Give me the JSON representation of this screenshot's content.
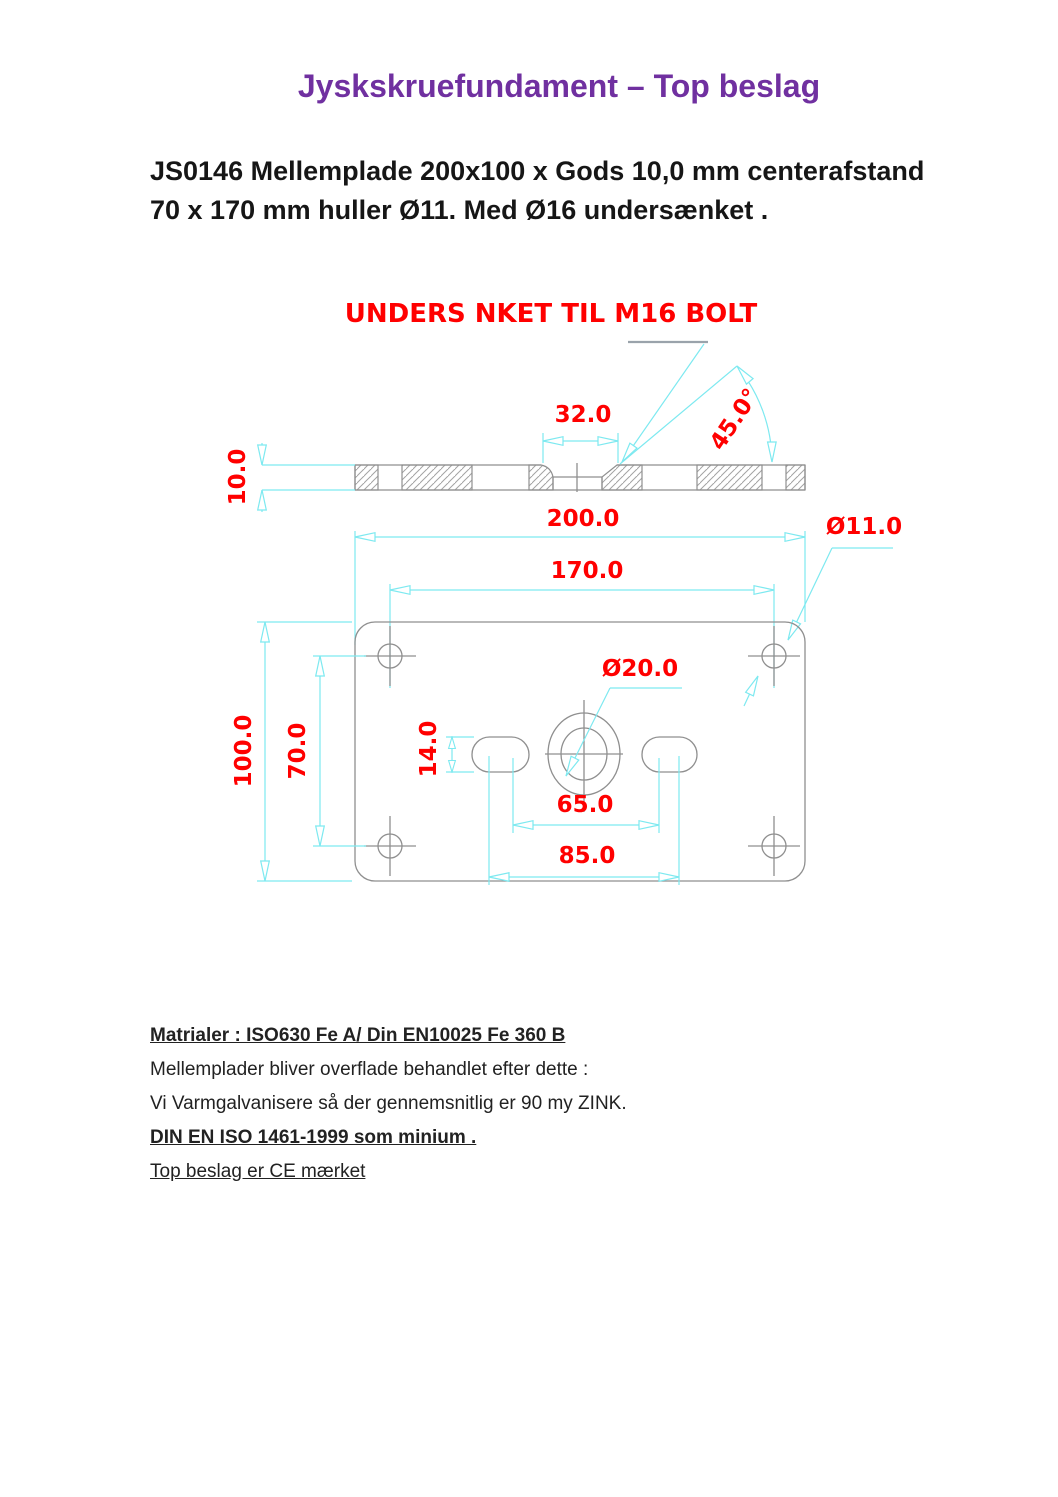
{
  "page": {
    "title": "Jyskskruefundament – Top beslag",
    "heading_line1": "JS0146 Mellemplade 200x100 x Gods 10,0 mm centerafstand",
    "heading_line2": "70 x 170 mm huller Ø11. Med Ø16 undersænket ."
  },
  "drawing": {
    "note": "UNDERS NKET TIL M16 BOLT",
    "labels": {
      "thickness": "10.0",
      "countersink_width": "32.0",
      "countersink_angle": "45.0°",
      "plate_length": "200.0",
      "hole_diameter": "Ø11.0",
      "hole_spacing_length": "170.0",
      "center_hole_diameter": "Ø20.0",
      "plate_width": "100.0",
      "hole_spacing_width": "70.0",
      "slot_width": "14.0",
      "slot_inner_spacing": "65.0",
      "slot_outer_spacing": "85.0"
    },
    "colors": {
      "dimension_text": "#ff0000",
      "dimension_lines": "#7de9f0",
      "geometry_lines": "#8f8f8f",
      "note_text": "#ff0000"
    }
  },
  "footer": {
    "materials": "Matrialer : ISO630 Fe A/ Din EN10025 Fe 360 B",
    "treatment": "Mellemplader bliver overflade behandlet efter dette :",
    "galvanization": "Vi Varmgalvanisere så der gennemsnitlig er 90 my ZINK.",
    "standard": "DIN EN ISO 1461-1999 som minium .",
    "ce_mark": "Top beslag er CE mærket"
  },
  "colors": {
    "title": "#7030A0",
    "body_text": "#161616",
    "page_background": "#ffffff"
  }
}
